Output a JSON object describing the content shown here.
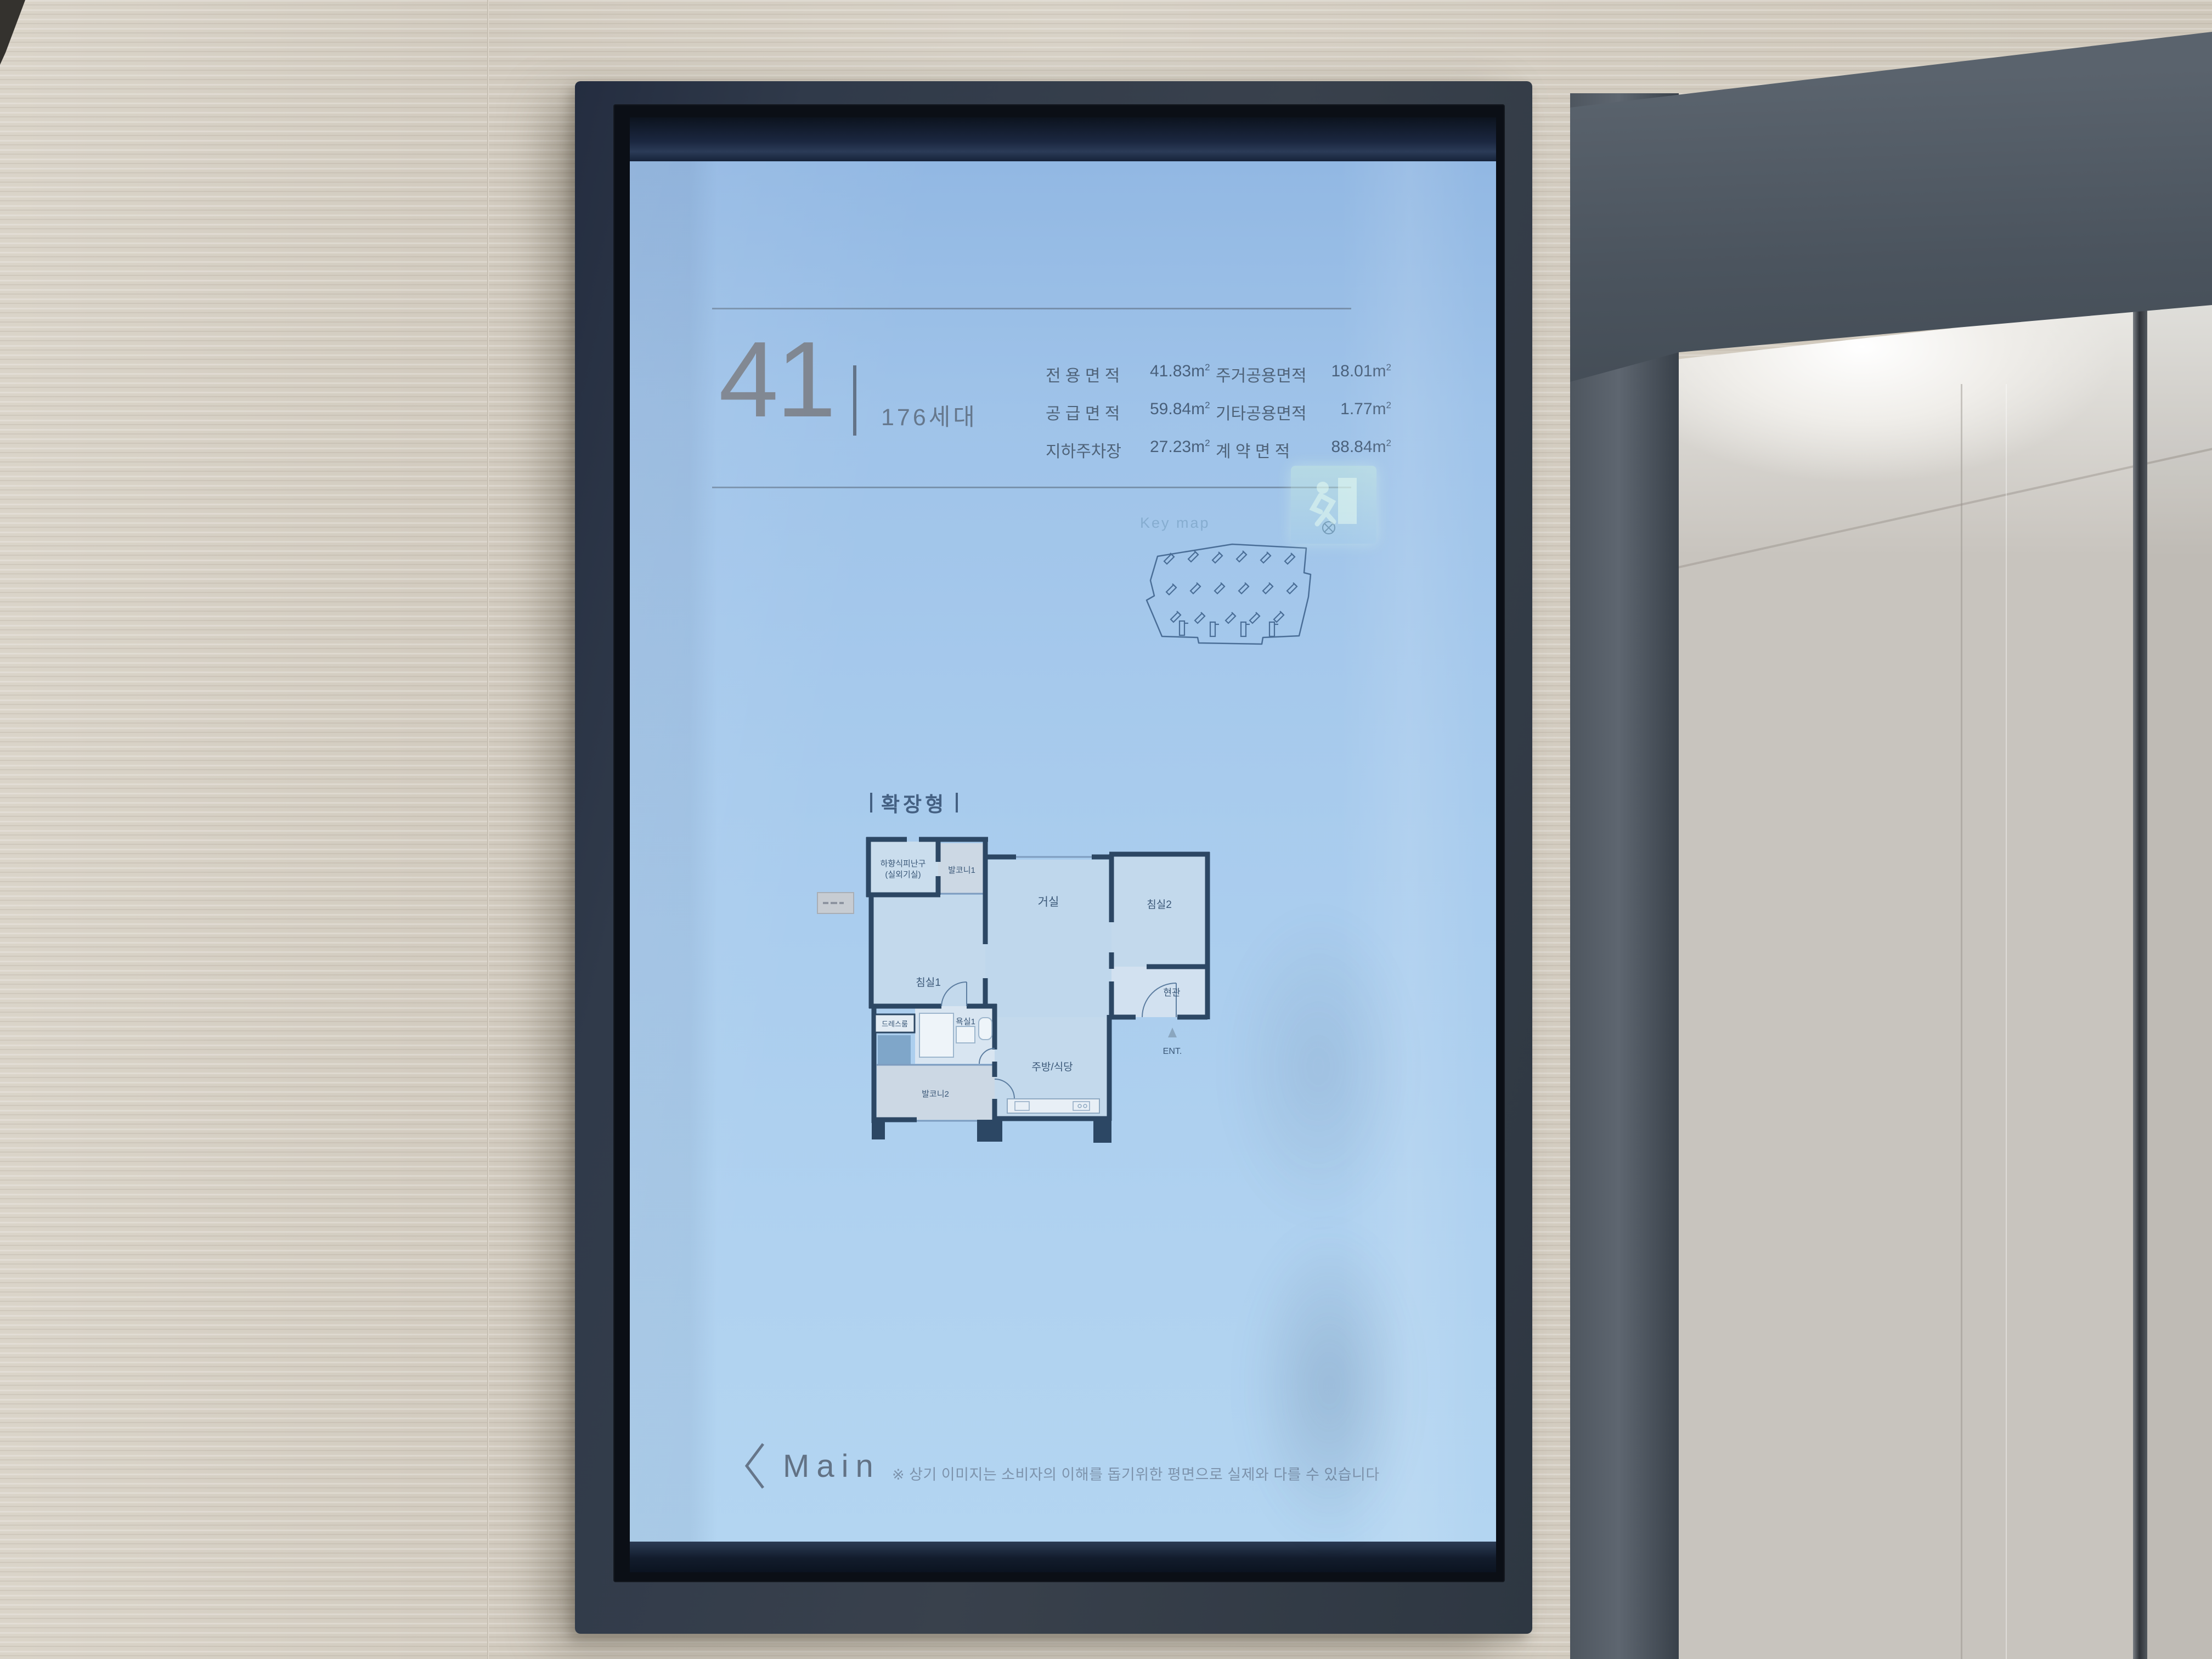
{
  "kiosk": {
    "screen": {
      "unit": {
        "number": "41",
        "households": "176세대"
      },
      "area_table": {
        "rows": [
          {
            "l_label": "전 용 면 적",
            "l_value": "41.83m",
            "l_sup": "2",
            "r_label": "주거공용면적",
            "r_value": "18.01m",
            "r_sup": "2"
          },
          {
            "l_label": "공 급 면 적",
            "l_value": "59.84m",
            "l_sup": "2",
            "r_label": "기타공용면적",
            "r_value": "1.77m",
            "r_sup": "2"
          },
          {
            "l_label": "지하주차장",
            "l_value": "27.23m",
            "l_sup": "2",
            "r_label": "계 약 면 적",
            "r_value": "88.84m",
            "r_sup": "2"
          }
        ]
      },
      "keymap": {
        "title": "Key map"
      },
      "plan": {
        "type_label": "확장형",
        "rooms": {
          "evac_line1": "하향식피난구",
          "evac_line2": "(실외기실)",
          "balcony1": "발코니1",
          "bedroom1": "침실1",
          "living": "거실",
          "bedroom2": "침실2",
          "entrance": "현관",
          "ent_mark": "ENT.",
          "dress": "드레스룸",
          "bath1": "욕실1",
          "balcony2": "발코니2",
          "kitchen": "주방/식당"
        }
      },
      "footer": {
        "main_label": "Main",
        "disclaimer": "※ 상기 이미지는 소비자의 이해를 돕기위한 평면으로 실제와 다를 수 있습니다"
      }
    },
    "colors": {
      "screen_blue": "#a8cbed",
      "plan_wall_navy": "#2c4764",
      "frame_charcoal": "#333b47",
      "text_slate": "#4f6379"
    }
  }
}
